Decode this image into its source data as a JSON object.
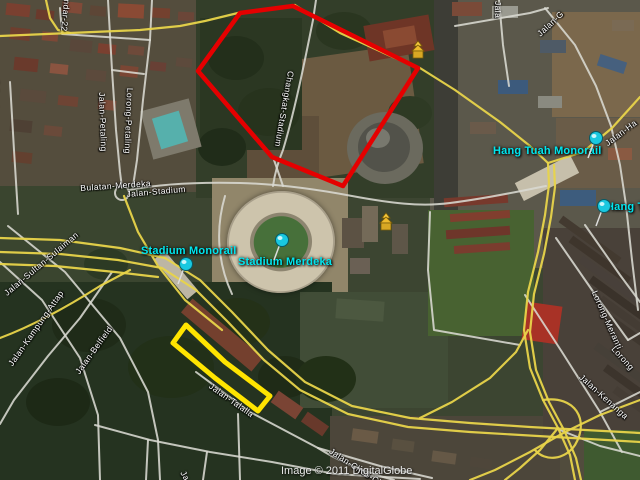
{
  "map": {
    "attribution": "Image © 2011 DigitalGlobe",
    "placemarks": [
      "Stadium Monorail",
      "Stadium Merdeka",
      "Hang Tuah Monorail",
      "Hang Tu"
    ],
    "road_labels": [
      "ndar-22",
      "Jalan-Petaling",
      "Lorong-Petaling",
      "Bulatan-Merdeka",
      "Jalan-Stadium",
      "Changkat-Stadium",
      "Jalan-H-S-Lee",
      "Jalan-Sultan-Sulaiman",
      "Jalan-Kampung-Attap",
      "Jalan-Belfield",
      "Jalan-Talalla",
      "Jalan-Choo-Ch",
      "Jalan-Kenanga",
      "Lorong-Meranti",
      "Lorong",
      "Jalan-G",
      "Jala",
      "Jalan-Ha",
      "Ja"
    ],
    "icons": {
      "placemark_pin": "pushpin-icon",
      "poi_building": "pagoda-icon"
    },
    "colors": {
      "boundary_red": "#e50000",
      "boundary_yellow": "#ffe400",
      "road_yellow": "#e8d44a",
      "road_white": "#d9d9d2",
      "placemark_cyan": "#00e5ee",
      "label_white": "#ffffff",
      "copyright": "#e8e8e8"
    }
  }
}
